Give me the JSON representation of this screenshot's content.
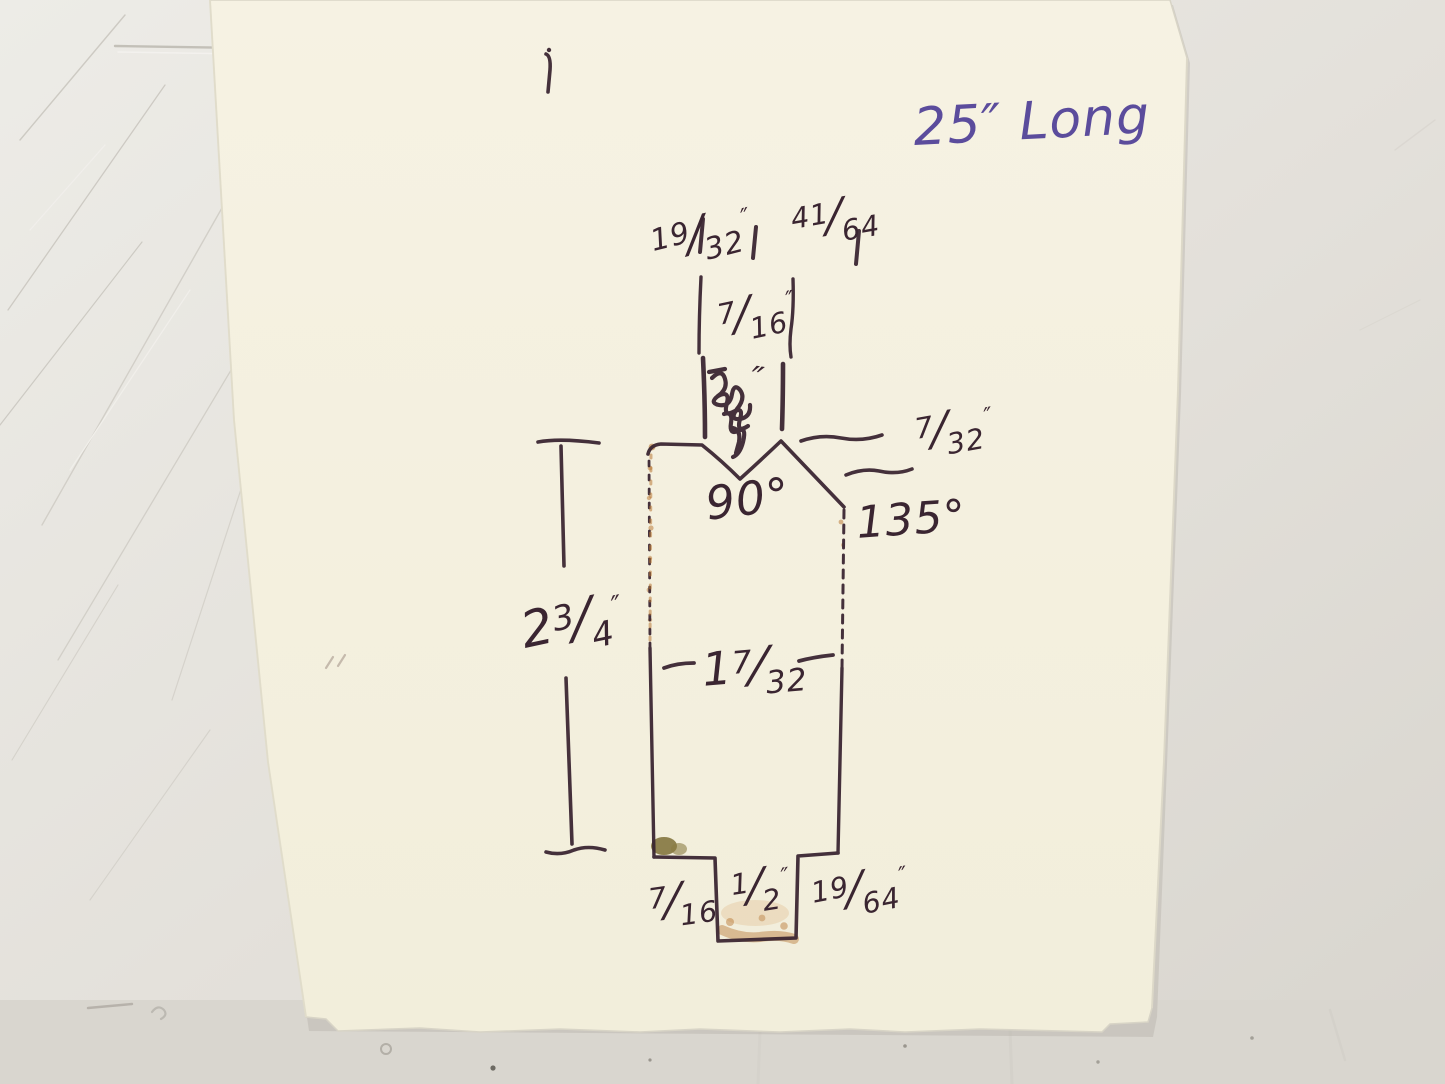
{
  "scene_description": "Photograph of a hand-drawn machining sketch on cream paper: cross-section of a press-brake die bar with a 90-degree V notch, 135-degree chamfer and bottom tang, with handwritten fractional dimensions",
  "glyphs": {
    "fraction_slash": "/",
    "inch_mark": "″"
  },
  "annotations": {
    "length_note": "25″ Long",
    "top_width_left": {
      "num": "19",
      "den": "32",
      "suffix": "″"
    },
    "top_width_right": {
      "num": "41",
      "den": "64",
      "suffix": ""
    },
    "tongue_width": {
      "num": "7",
      "den": "16",
      "suffix": "″"
    },
    "scribbled_value_mark": "″",
    "notch_depth": {
      "num": "7",
      "den": "32",
      "suffix": "″"
    },
    "v_notch_angle": "90°",
    "chamfer_angle": "135°",
    "overall_height": {
      "whole": "2",
      "num": "3",
      "den": "4",
      "suffix": "″"
    },
    "body_width": {
      "whole": "1",
      "num": "7",
      "den": "32",
      "suffix": ""
    },
    "bottom_left_offset": {
      "num": "7",
      "den": "16",
      "suffix": ""
    },
    "tab_width": {
      "num": "1",
      "den": "2",
      "suffix": "″"
    },
    "bottom_right_offset": {
      "num": "19",
      "den": "64",
      "suffix": "″"
    }
  },
  "colors": {
    "ink": "#3a2531",
    "note_ink": "#5b4c9c",
    "paper": "#f5f1df",
    "table": "#e4e1db",
    "rust_stain": "#b5712c",
    "olive_stain": "#7d6f36"
  }
}
